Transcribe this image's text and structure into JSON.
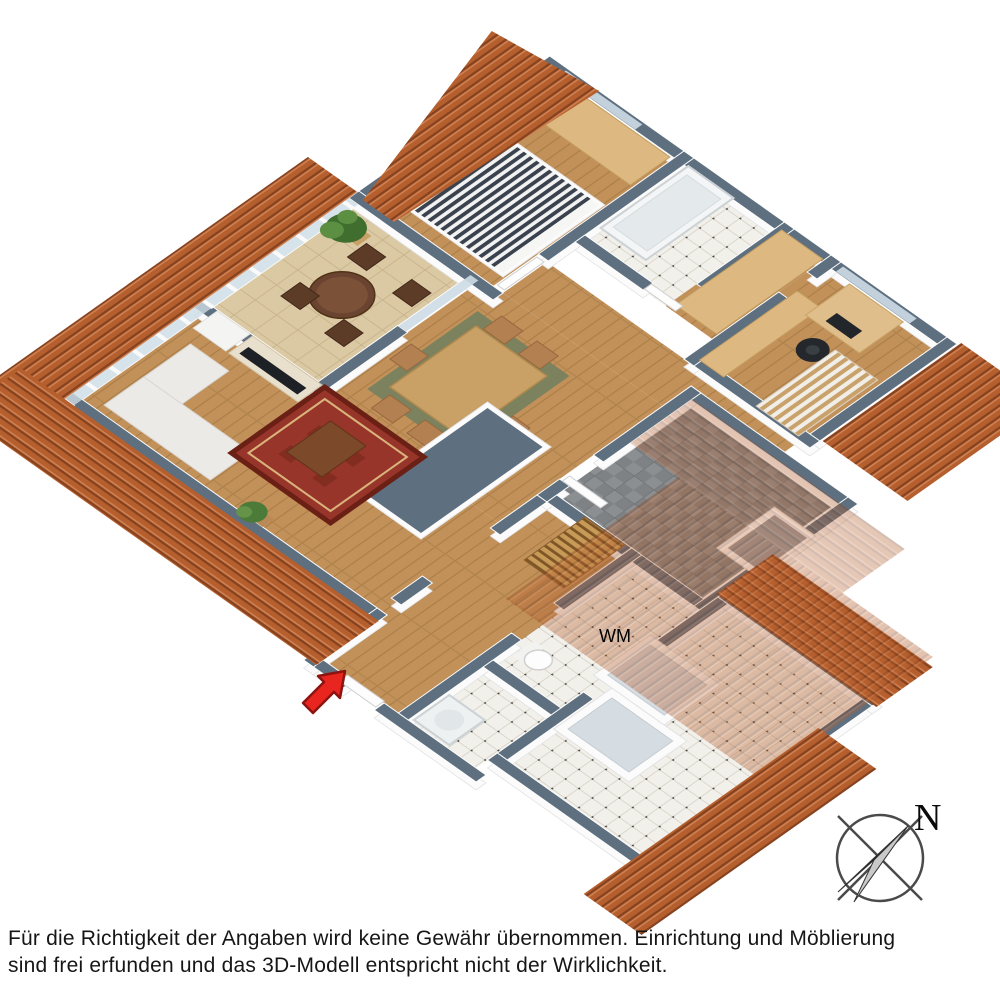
{
  "scene": {
    "type": "isometric-3d-floor-plan",
    "subject": "3D model floor plan of an attic apartment with terracotta roof"
  },
  "labels": {
    "washing_machine": "WM",
    "compass_north": "N"
  },
  "disclaimer": {
    "line1": "Für die Richtigkeit der Angaben wird keine Gewähr übernommen. Einrichtung und Möblierung",
    "line2": "sind frei erfunden und das 3D-Modell entspricht nicht der Wirklichkeit."
  },
  "colors": {
    "roof_base": "#b65f2e",
    "roof_dark": "#87431f",
    "roof_light": "#d08152",
    "wall_slate": "#5e6f7f",
    "wood_floor": "#c2915a",
    "tile_white": "#f2f0ea",
    "tile_grey": "#8b8f92",
    "balcony_tile": "#dbc9a4",
    "glass": "#cddce5",
    "rug_red": "#98352b",
    "rug_green": "#78815f",
    "furniture_wood": "#ddb981",
    "arrow_red": "#e8251f",
    "text": "#161616"
  },
  "elements": [
    "terracotta-roof-bands",
    "semi-transparent-roof-overlay",
    "balcony-terrace",
    "balcony-railing-glass",
    "balcony-round-table-chairs",
    "potted-palm",
    "living-room-sofa",
    "tv-on-sideboard",
    "tall-cabinet",
    "oriental-red-rug",
    "coffee-table",
    "house-plant",
    "dining-table-chairs",
    "green-area-rug",
    "kitchen-island",
    "double-bed-striped",
    "bedroom-wardrobe",
    "bathtub-bathroom",
    "hallway-wardrobes",
    "home-office-desk",
    "office-chair",
    "staircase",
    "storage-room-grey-tile",
    "roof-window-skylights",
    "shower-room",
    "toilet",
    "washing-machine-spot",
    "entrance-red-arrow",
    "compass-rose"
  ]
}
